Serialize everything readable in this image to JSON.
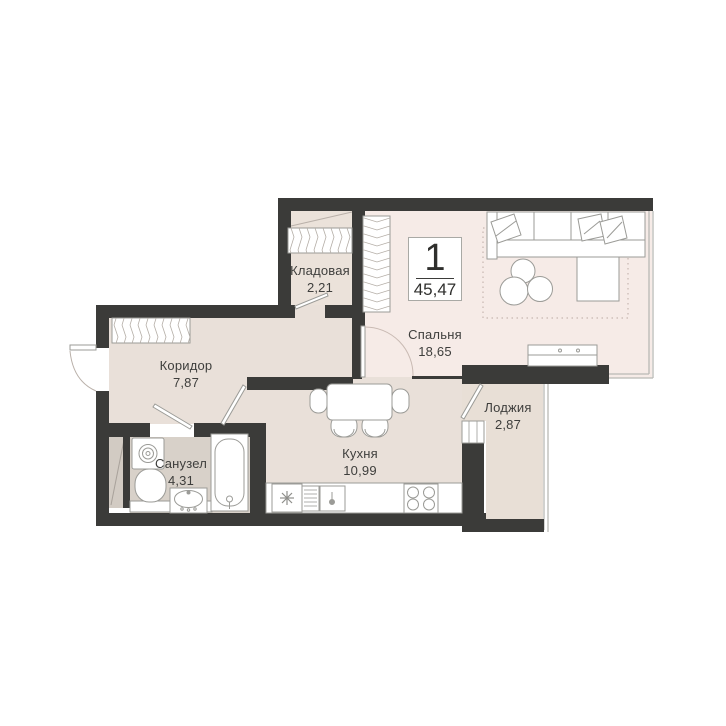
{
  "page": {
    "background": "#ffffff",
    "title": "floor-plan"
  },
  "plan": {
    "badge": {
      "rooms_count": "1",
      "total_area": "45,47"
    },
    "rooms": [
      {
        "id": "storage",
        "label": "Кладовая",
        "area": "2,21"
      },
      {
        "id": "corridor",
        "label": "Коридор",
        "area": "7,87"
      },
      {
        "id": "bathroom",
        "label": "Санузел",
        "area": "4,31"
      },
      {
        "id": "kitchen",
        "label": "Кухня",
        "area": "10,99"
      },
      {
        "id": "bedroom",
        "label": "Спальня",
        "area": "18,65"
      },
      {
        "id": "loggia",
        "label": "Лоджия",
        "area": "2,87"
      }
    ],
    "colors": {
      "wall": "#3b3b39",
      "floor_bedroom": "#f6ebe7",
      "floor_main": "#e9e0d9",
      "floor_storage": "#ebe2da",
      "floor_bathroom": "#d8d1c9",
      "floor_loggia": "#e8dfd6",
      "floor_shaft": "#d2cbc3",
      "furniture_outline": "#9b9b97",
      "hatch": "#b4ada6",
      "text": "#3e3e3c"
    },
    "fixtures": {
      "bedroom": [
        "corner-sofa-icon",
        "pillow-icon",
        "pouf-icon",
        "rug-icon",
        "tv-stand-icon",
        "wardrobe-icon"
      ],
      "kitchen": [
        "dining-table-icon",
        "chair-icon",
        "fridge-snowflake-icon",
        "dish-rack-icon",
        "kitchen-sink-icon",
        "stove-icon"
      ],
      "bathroom": [
        "washing-machine-icon",
        "toilet-icon",
        "washbasin-icon",
        "bathtub-icon"
      ],
      "corridor": [
        "wardrobe-icon"
      ],
      "storage": [
        "shelving-icon"
      ]
    }
  }
}
